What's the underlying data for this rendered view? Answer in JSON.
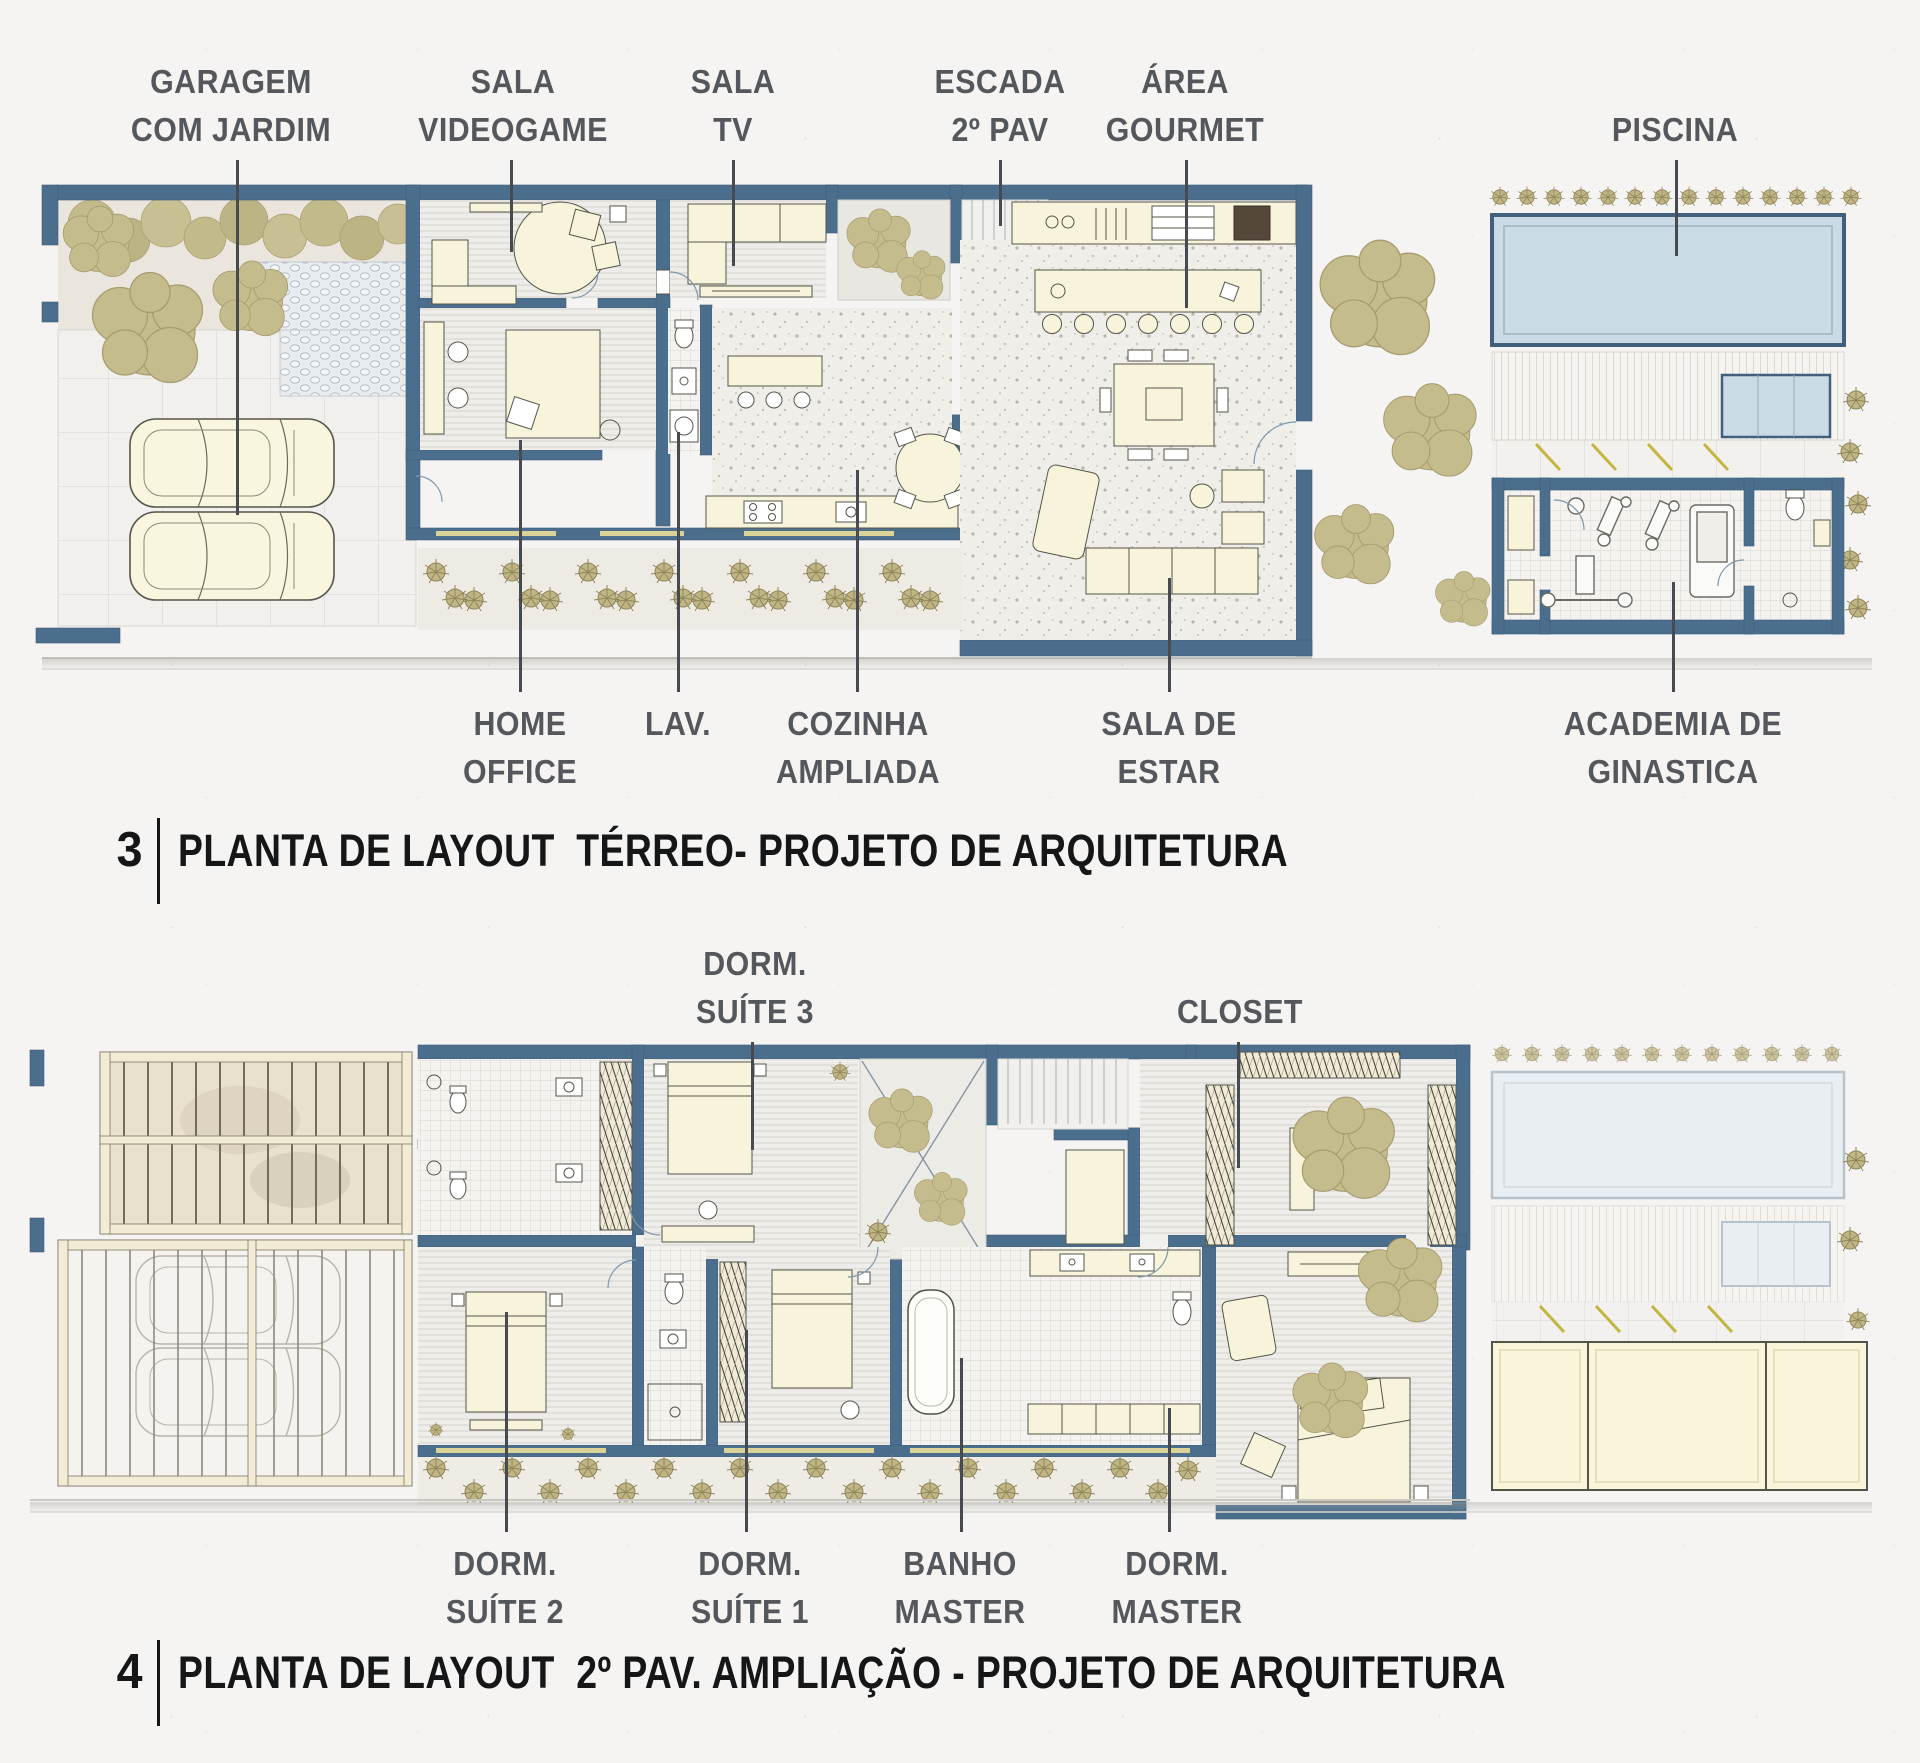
{
  "document": {
    "type": "architecture-floor-plan-sheet",
    "language": "pt-BR"
  },
  "figures": [
    {
      "number": "3",
      "caption": "PLANTA DE LAYOUT  TÉRREO- PROJETO DE ARQUITETURA",
      "labels_top": [
        {
          "l1": "GARAGEM",
          "l2": "COM JARDIM"
        },
        {
          "l1": "SALA",
          "l2": "VIDEOGAME"
        },
        {
          "l1": "SALA",
          "l2": "TV"
        },
        {
          "l1": "ESCADA",
          "l2": "2º PAV"
        },
        {
          "l1": "ÁREA",
          "l2": "GOURMET"
        },
        {
          "l1": "PISCINA",
          "l2": ""
        }
      ],
      "labels_bottom": [
        {
          "l1": "HOME",
          "l2": "OFFICE"
        },
        {
          "l1": "LAV.",
          "l2": ""
        },
        {
          "l1": "COZINHA",
          "l2": "AMPLIADA"
        },
        {
          "l1": "SALA DE",
          "l2": "ESTAR"
        },
        {
          "l1": "ACADEMIA DE",
          "l2": "GINASTICA"
        }
      ]
    },
    {
      "number": "4",
      "caption": "PLANTA DE LAYOUT  2º PAV. AMPLIAÇÃO - PROJETO DE ARQUITETURA",
      "labels_top": [
        {
          "l1": "DORM.",
          "l2": "SUÍTE 3"
        },
        {
          "l1": "CLOSET",
          "l2": ""
        }
      ],
      "labels_bottom": [
        {
          "l1": "DORM.",
          "l2": "SUÍTE 2"
        },
        {
          "l1": "DORM.",
          "l2": "SUÍTE 1"
        },
        {
          "l1": "BANHO",
          "l2": "MASTER"
        },
        {
          "l1": "DORM.",
          "l2": "MASTER"
        }
      ]
    }
  ],
  "colors": {
    "page_background": "#f5f4f2",
    "wall": "#4c6e8d",
    "furniture_cream": "#f7f4db",
    "vegetation_khaki": "#c5bc8e",
    "pool_blue": "#cbdbe5",
    "pool_faded": "#e9eef2",
    "label_text": "#54585d",
    "caption_text": "#141618",
    "leader_line": "#474b4f",
    "window_yellow": "#d9d398"
  }
}
